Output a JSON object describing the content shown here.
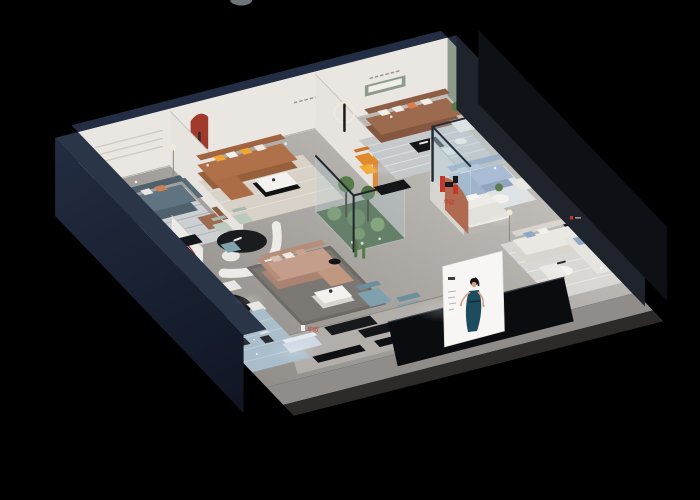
{
  "scene": {
    "background": "#000000",
    "description": "isometric-cutaway-3d-furniture-showroom-render"
  },
  "branding": {
    "logo_letter": "H",
    "brand_cn": "华欧"
  },
  "rooms": [
    "left-lounge-display",
    "caramel-sofa-display",
    "walnut-sofa-display",
    "glass-lounge-display",
    "bedroom-display",
    "premium-lounge-display",
    "indoor-garden",
    "center-lounge-display",
    "reception-area",
    "dining-display",
    "entry-display",
    "storefront"
  ],
  "palette": {
    "bg": "#000000",
    "capNavy": "#232e44",
    "leftWallA": "#222c40",
    "leftWallB": "#0e1320",
    "rightWallOuter": "#1e232c",
    "rightWallEdge": "#0d1015",
    "wall": "#eae7e2",
    "wallR": "#e0ddd7",
    "sage": "#8d9b8c",
    "arch": "#f3f1ec",
    "redA": "#a13a2d",
    "rust": "#b06a4f",
    "caramel": "#b0714a",
    "caramelD": "#96603c",
    "walnut": "#9c6a4e",
    "walnutD": "#855640",
    "slate": "#5f7480",
    "slateD": "#4e616c",
    "blush": "#c49d8b",
    "blushD": "#ab8372",
    "steel": "#a9bcd4",
    "steelD": "#90a6c0",
    "teal": "#7fa0ad",
    "tealD": "#6d8e9b",
    "cream": "#eae8e3",
    "creamD": "#d8d5cf",
    "yellow": "#f0a832",
    "orange": "#e08a2e",
    "mint": "#bcc9bd",
    "dark": "#141619",
    "garden": "#47633f",
    "moss": "#6f8f5a",
    "glassFill": "rgba(176,205,214,0.28)",
    "frame": "#2b3440",
    "blueRug": "#a9bdcb",
    "panelGray": "#83878c",
    "brandRed": "#c3392c",
    "skin": "#d9a183",
    "dress": "#1d4c5f",
    "posterBg": "#f7f6f4",
    "slab": "#8f8c89",
    "letter": "#9b968f"
  }
}
